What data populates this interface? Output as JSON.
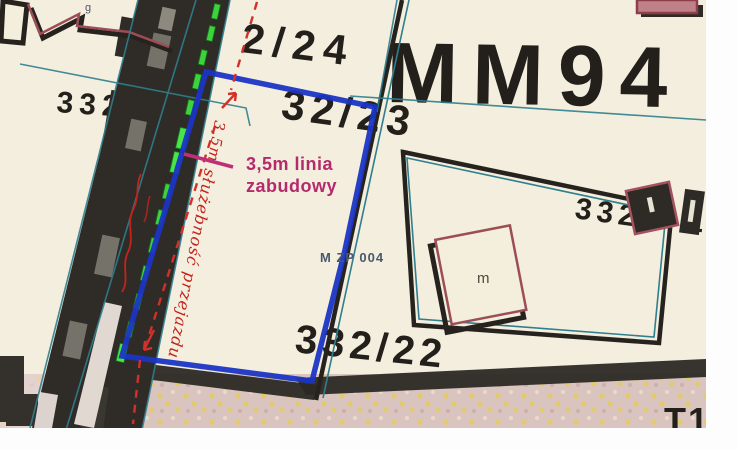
{
  "document": {
    "kind": "scanned cadastral base map with plan annotations"
  },
  "labels": {
    "grid_ref": "MM94",
    "parcel_24": "2/24",
    "parcel_23": "32/23",
    "parcel_22": "332/22",
    "parcel_left_num": "332",
    "parcel_left_suffix": "/7",
    "parcel_right_num": "332",
    "parcel_right_frag": "1",
    "plan_unit": "M ZP 004",
    "house_m": "m",
    "corner_g": "g",
    "street_partial": "T1"
  },
  "annotations": {
    "building_line_1": "3,5m linia",
    "building_line_2": "zabudowy",
    "dimension": "3,5m",
    "servitude": "służebność przejazdu",
    "roadside_script": "illegible handwriting along road"
  },
  "colors": {
    "paper": "#f3eedd",
    "road": "#2f2c27",
    "highlight_blue": "#1b35c4",
    "annotation_red": "#d2302a",
    "annotation_magenta": "#b42a6d",
    "survey_teal": "#2f7f8e",
    "vegetation_green": "#3fd23f",
    "building_outline": "#9c4e57",
    "ink": "#23201c",
    "street_fill": "#d9c4bf",
    "street_dot": "#e4cb6a",
    "page_margin": "#fdfdfd"
  }
}
